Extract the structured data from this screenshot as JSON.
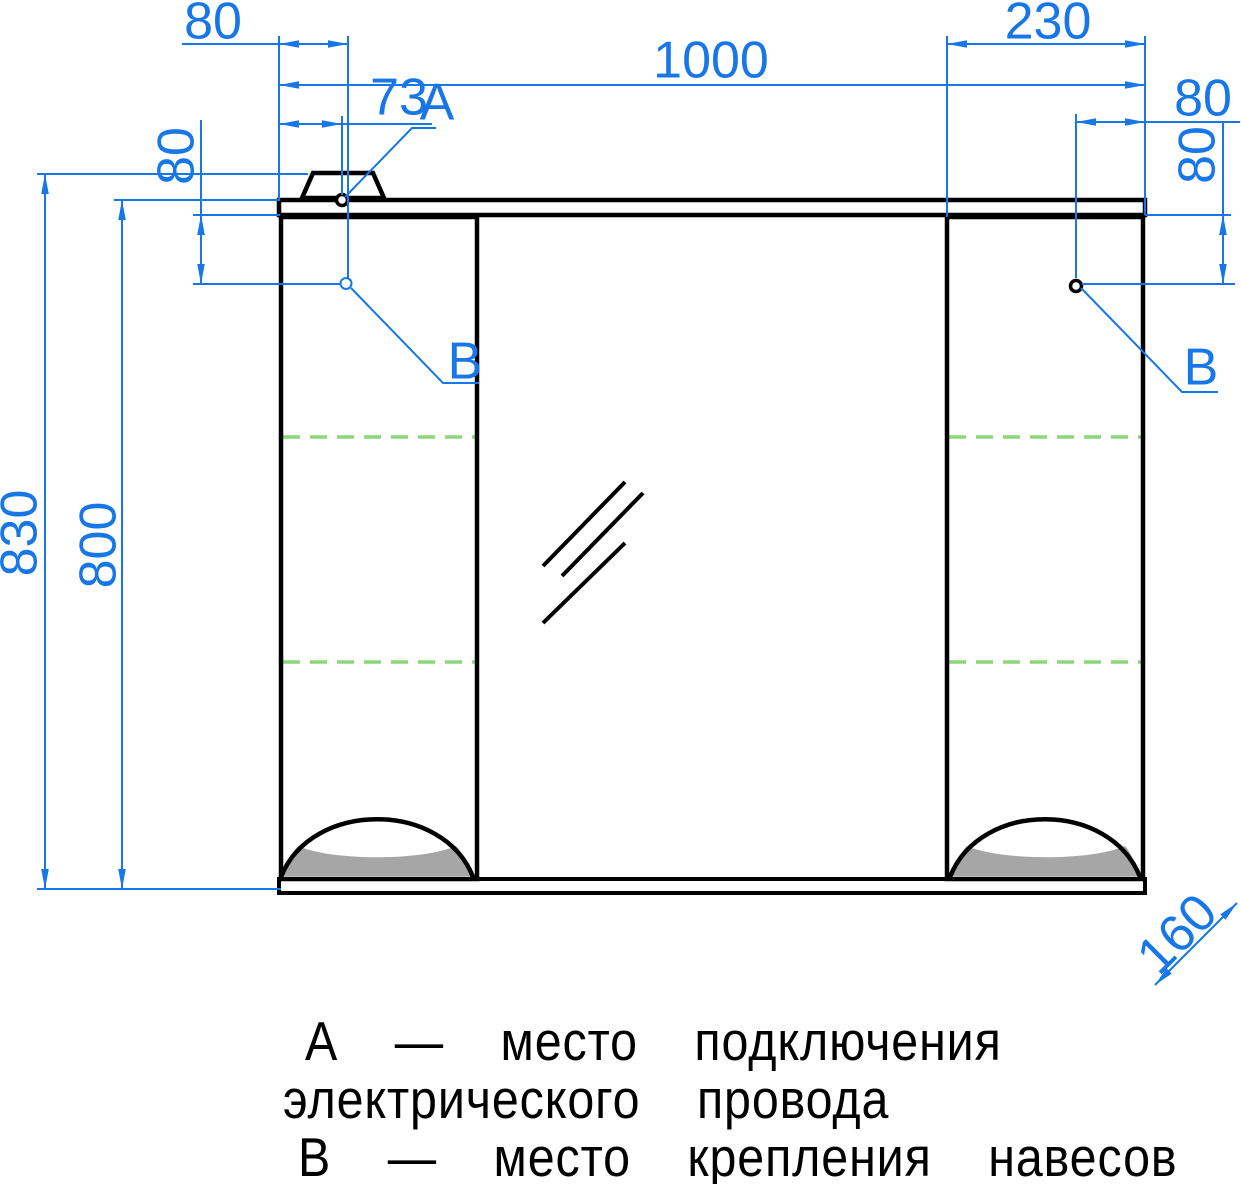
{
  "drawing": {
    "type": "furniture-dimension-drawing",
    "dimensions": {
      "hanger_offset_top": "80",
      "power_point_offset": "73",
      "overall_width": "1000",
      "right_cabinet_width": "230",
      "hanger_offset_right": "80",
      "hanger_drop_right": "80",
      "hanger_drop_left": "80",
      "overall_height": "830",
      "body_height": "800",
      "depth": "160"
    },
    "point_labels": {
      "a": "А",
      "b_left": "В",
      "b_right": "В"
    },
    "legend": {
      "line1": "А — место подключения",
      "line2": "электрического провода",
      "line3": "В — место крепления навесов"
    },
    "colors": {
      "dimension": "#1777e8",
      "shelf": "#8bd878",
      "lamp_fill": "#a6a6a6",
      "outline": "#000000"
    }
  }
}
